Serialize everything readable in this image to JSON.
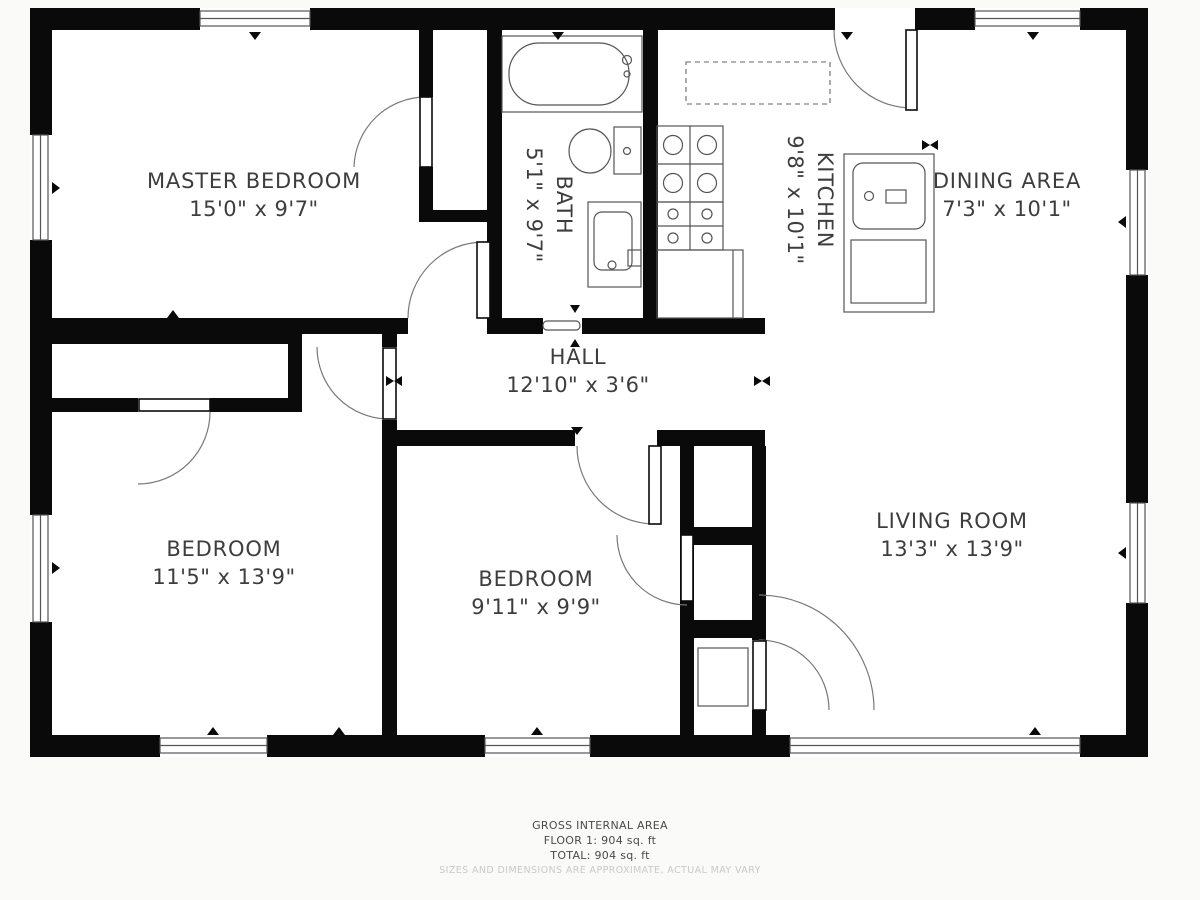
{
  "plan": {
    "rooms": [
      {
        "name": "MASTER BEDROOM",
        "dims": "15'0\" x 9'7\""
      },
      {
        "name": "BATH",
        "dims": "5'1\" x 9'7\""
      },
      {
        "name": "KITCHEN",
        "dims": "9'8\" x 10'1\""
      },
      {
        "name": "DINING AREA",
        "dims": "7'3\" x 10'1\""
      },
      {
        "name": "HALL",
        "dims": "12'10\" x 3'6\""
      },
      {
        "name": "BEDROOM",
        "dims": "11'5\" x 13'9\""
      },
      {
        "name": "BEDROOM",
        "dims": "9'11\" x 9'9\""
      },
      {
        "name": "LIVING ROOM",
        "dims": "13'3\" x 13'9\""
      }
    ],
    "colors": {
      "wall": "#0a0a0a",
      "line": "#555555",
      "label": "#3d3d3d",
      "background": "#fafaf8"
    }
  },
  "footer": {
    "line1": "GROSS INTERNAL AREA",
    "line2": "FLOOR 1: 904 sq. ft",
    "line3": "TOTAL: 904 sq. ft",
    "disclaimer": "SIZES AND DIMENSIONS ARE APPROXIMATE, ACTUAL MAY VARY"
  }
}
